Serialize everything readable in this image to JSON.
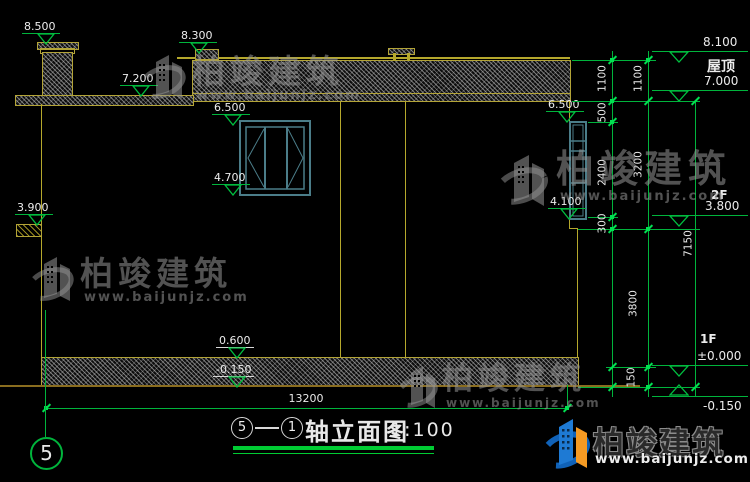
{
  "drawing": {
    "title": {
      "axis_a": "5",
      "axis_b": "1",
      "name": "轴立面图",
      "scale": "1:100"
    },
    "axis_bubble_left": "5",
    "levels": {
      "chimney_top": "8.500",
      "parapet_cap": "8.300",
      "porch_roof": "7.200",
      "win_head_mid": "6.500",
      "win_sill_mid": "4.700",
      "porch_slab": "3.900",
      "win_head_right": "6.500",
      "win_sill_right": "4.100",
      "plinth_top": "0.600",
      "ground_center": "-0.150",
      "roof_top": "8.100",
      "roof_label": "屋顶",
      "roof_level": "7.000",
      "floor2_label": "2F",
      "floor2": "3.800",
      "floor1_label": "1F",
      "floor1": "±0.000",
      "ground_right": "-0.150"
    },
    "dims": {
      "d1100a": "1100",
      "d1100b": "1100",
      "d500": "500",
      "d2400": "2400",
      "d3200": "3200",
      "d300": "300",
      "d3800": "3800",
      "d7150": "7150",
      "d150": "150",
      "d13200": "13200"
    },
    "watermark": {
      "brand": "柏竣建筑",
      "url": "www.baijunjz.com"
    },
    "logo": {
      "brand": "柏竣建筑",
      "url": "www.baijunjz.com"
    },
    "colors": {
      "line_yellow": "#b3a437",
      "dim_green": "#00b43c",
      "window_teal": "#4b7d89"
    }
  }
}
